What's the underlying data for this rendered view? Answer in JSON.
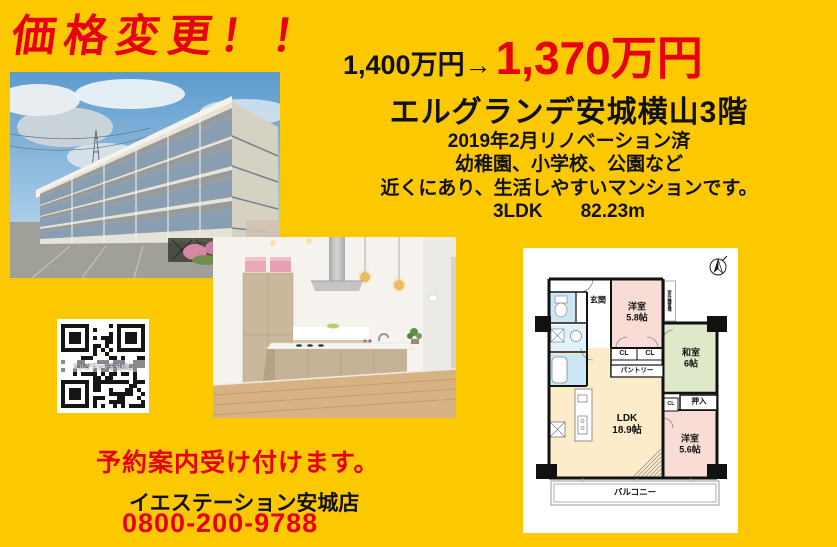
{
  "colors": {
    "background": "#FCC800",
    "accent_red": "#E60012",
    "text_black": "#111111",
    "plan_pink": "#F8DCD5",
    "plan_green": "#DDE9C9",
    "plan_cream": "#FCECCA",
    "plan_blue": "#CDE6F3"
  },
  "banner": {
    "price_change": "価格変更！！"
  },
  "price": {
    "old": "1,400万円→",
    "new": "1,370万円"
  },
  "property": {
    "name": "エルグランデ安城横山3階",
    "lines": [
      "2019年2月リノベーション済",
      "幼稚園、小学校、公園など",
      "近くにあり、生活しやすいマンションです。",
      "3LDK　　82.23m"
    ]
  },
  "qr": {
    "caption": "エルグランデ安城横山"
  },
  "floorplan": {
    "labels": {
      "genkan": "玄関",
      "western1": "洋室\n5.8帖",
      "outdoor_unit": "室外機置場",
      "japanese": "和室\n6帖",
      "cl_a": "CL",
      "cl_b": "CL",
      "pantry": "パントリー",
      "oshiire": "押入",
      "cl_c": "CL",
      "ldk": "LDK\n18.9帖",
      "western2": "洋室\n5.6帖",
      "balcony": "バルコニー"
    }
  },
  "footer": {
    "reservation": "予約案内受け付けます。",
    "store_name": "イエステーション安城店",
    "phone": "0800-200-9788"
  }
}
